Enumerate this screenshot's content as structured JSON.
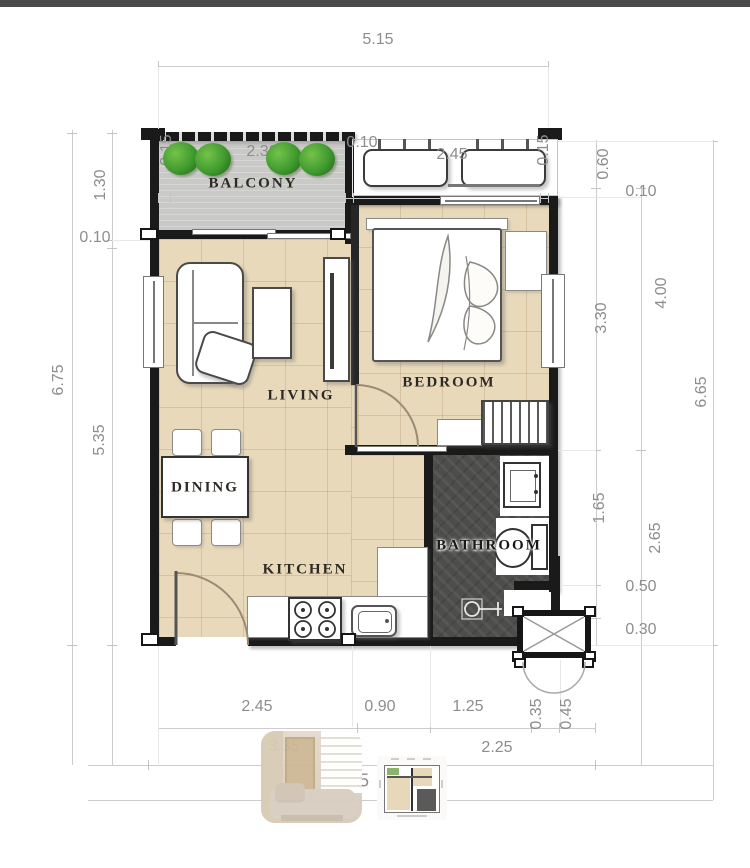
{
  "title": "apartment-floor-plan",
  "rooms": {
    "balcony": "BALCONY",
    "living": "LIVING",
    "bedroom": "BEDROOM",
    "dining": "DINING",
    "kitchen": "KITCHEN",
    "bathroom": "BATHROOM"
  },
  "dims": {
    "top": [
      "5.15",
      "0.15",
      "2.30",
      "0.10",
      "2.45",
      "0.15"
    ],
    "left": [
      "1.30",
      "0.10",
      "6.75",
      "5.35"
    ],
    "right": [
      "0.60",
      "0.10",
      "3.30",
      "4.00",
      "6.65",
      "1.65",
      "2.65",
      "0.50",
      "0.30"
    ],
    "bottom1": [
      "2.45",
      "0.90",
      "1.25",
      "0.35",
      "0.45"
    ],
    "bottom2": [
      "3.35",
      "2.25"
    ],
    "bottom3_partial": "5"
  },
  "colors": {
    "wall": "#1a1a1a",
    "floor_tile": "#e8d9ba",
    "balcony_floor": "#c9c9c7",
    "bathroom_floor": "#4d4d4b",
    "plant_green": "#3f9b2f",
    "dimension_text": "#8d8d8d",
    "label_text": "#2d2a24"
  },
  "icons": {
    "plants": "plant-icon",
    "ac_units": "ac-unit-icon",
    "stove": "stove-icon",
    "sink": "sink-icon",
    "toilet": "toilet-icon",
    "shower": "shower-icon",
    "shaft": "pipe-shaft-icon"
  }
}
